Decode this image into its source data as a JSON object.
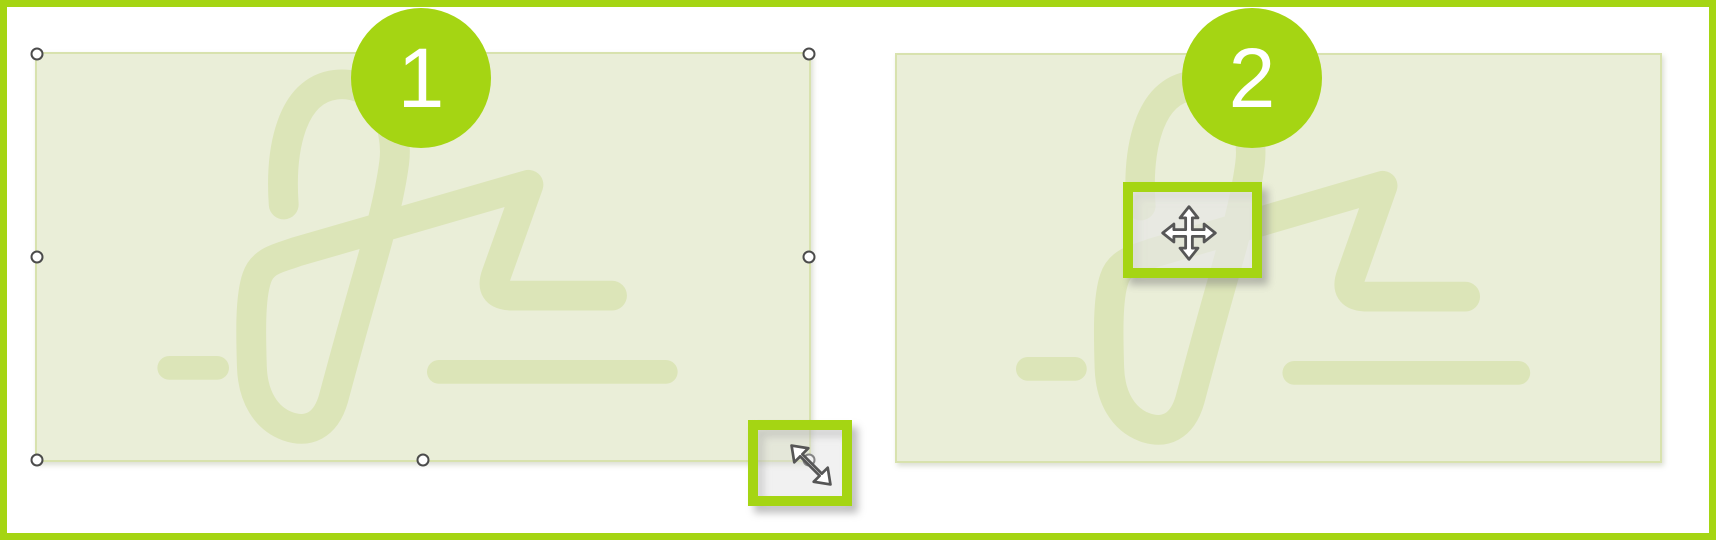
{
  "badges": {
    "step1": "1",
    "step2": "2"
  },
  "panels": {
    "step1": {
      "object": "signature-image-placeholder",
      "state": "selected-with-resize-handles"
    },
    "step2": {
      "object": "signature-image-placeholder",
      "state": "unselected"
    }
  },
  "icons": {
    "resize_cursor": "diagonal-resize-cursor-icon",
    "move_cursor": "move-cursor-icon"
  },
  "colors": {
    "accent_green": "#a5d513",
    "canvas_white": "#ffffff",
    "placeholder_fill": "#eaeed8",
    "placeholder_border": "#d8e2ae",
    "signature_stroke": "#dce5b8",
    "handle_outline": "#4b4b4b",
    "cursor_outline": "#565656"
  }
}
